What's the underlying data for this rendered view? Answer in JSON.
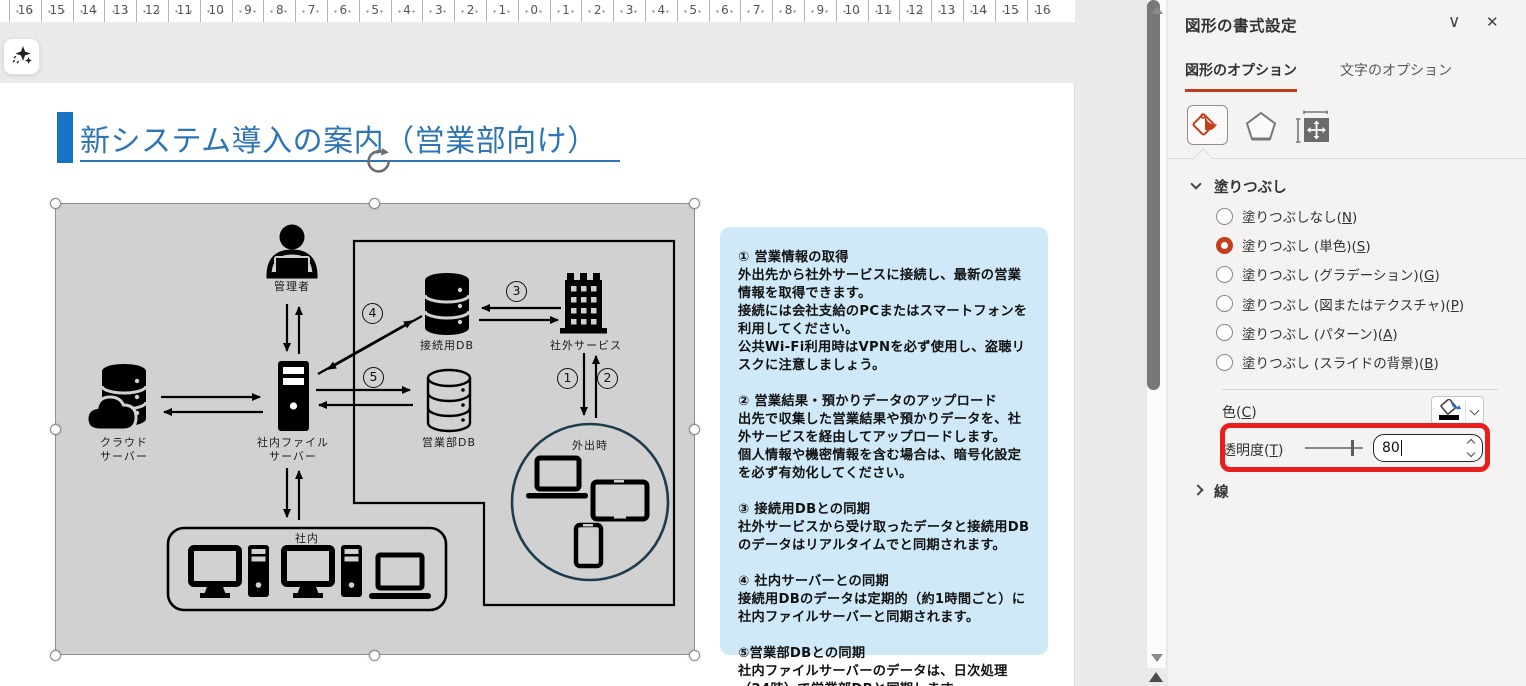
{
  "ruler": {
    "numbers": [
      "16",
      "15",
      "14",
      "13",
      "12",
      "11",
      "10",
      "9",
      "8",
      "7",
      "6",
      "5",
      "4",
      "3",
      "2",
      "1",
      "0",
      "1",
      "2",
      "3",
      "4",
      "5",
      "6",
      "7",
      "8",
      "9",
      "10",
      "11",
      "12",
      "13",
      "14",
      "15",
      "16"
    ]
  },
  "icons": {
    "sparkle_icon": "designer-sparkles",
    "rotate_handle_icon": "rotate-arrow",
    "collapse_icon": "∨",
    "close_icon": "✕",
    "fill_bucket_icon": "fill-and-line-bucket",
    "effects_icon": "pentagon-effects",
    "size_properties_icon": "size-and-properties",
    "color_bucket_icon": "font-fill-bucket-black",
    "scroll_up_icon": "triangle-up",
    "scroll_down_icon": "triangle-down"
  },
  "slide": {
    "title": "新システム導入の案内（営業部向け）",
    "diagram": {
      "labels": {
        "admin": "管理者",
        "cloud_server": "クラウド\nサーバー",
        "file_server": "社内ファイル\nサーバー",
        "connect_db": "接続用DB",
        "external_service": "社外サービス",
        "sales_db": "営業部DB",
        "out_of_office": "外出時",
        "in_office": "社内"
      },
      "step_markers": [
        "1",
        "2",
        "3",
        "4",
        "5"
      ]
    },
    "notes": {
      "paragraphs": [
        "① 営業情報の取得\n外出先から社外サービスに接続し、最新の営業情報を取得できます。\n接続には会社支給のPCまたはスマートフォンを利用してください。\n公共Wi-Fi利用時はVPNを必ず使用し、盗聴リスクに注意しましょう。",
        "② 営業結果・預かりデータのアップロード\n出先で収集した営業結果や預かりデータを、社外サービスを経由してアップロードします。\n個人情報や機密情報を含む場合は、暗号化設定を必ず有効化してください。",
        "③ 接続用DBとの同期\n社外サービスから受け取ったデータと接続用DBのデータはリアルタイムでと同期されます。",
        "④ 社内サーバーとの同期\n接続用DBのデータは定期的（約1時間ごと）に社内ファイルサーバーと同期されます。",
        "⑤営業部DBとの同期\n社内ファイルサーバーのデータは、日次処理（24時）で営業部DBと同期します。"
      ]
    }
  },
  "panel": {
    "title": "図形の書式設定",
    "tabs": [
      {
        "label": "図形のオプション",
        "active": true
      },
      {
        "label": "文字のオプション",
        "active": false
      }
    ],
    "fill": {
      "header": "塗りつぶし",
      "options": [
        {
          "text": "塗りつぶしなし",
          "key": "N",
          "selected": false
        },
        {
          "text": "塗りつぶし (単色)",
          "key": "S",
          "selected": true
        },
        {
          "text": "塗りつぶし (グラデーション)",
          "key": "G",
          "selected": false
        },
        {
          "text": "塗りつぶし (図またはテクスチャ)",
          "key": "P",
          "selected": false
        },
        {
          "text": "塗りつぶし (パターン)",
          "key": "A",
          "selected": false
        },
        {
          "text": "塗りつぶし (スライドの背景)",
          "key": "B",
          "selected": false
        }
      ],
      "color_label": {
        "text": "色",
        "key": "C"
      },
      "transparency_label": {
        "text": "透明度",
        "key": "T"
      },
      "transparency_value": "80"
    },
    "line": {
      "header": "線"
    }
  },
  "colors": {
    "accent_red": "#c43e1c",
    "highlight_red": "#e8201d",
    "title_blue": "#2e75b6",
    "title_bar_blue": "#1873c4",
    "notes_bg": "#cfe9f8",
    "shape_gray": "#d2d1d1",
    "out_circle_border": "#1d3c4e"
  }
}
